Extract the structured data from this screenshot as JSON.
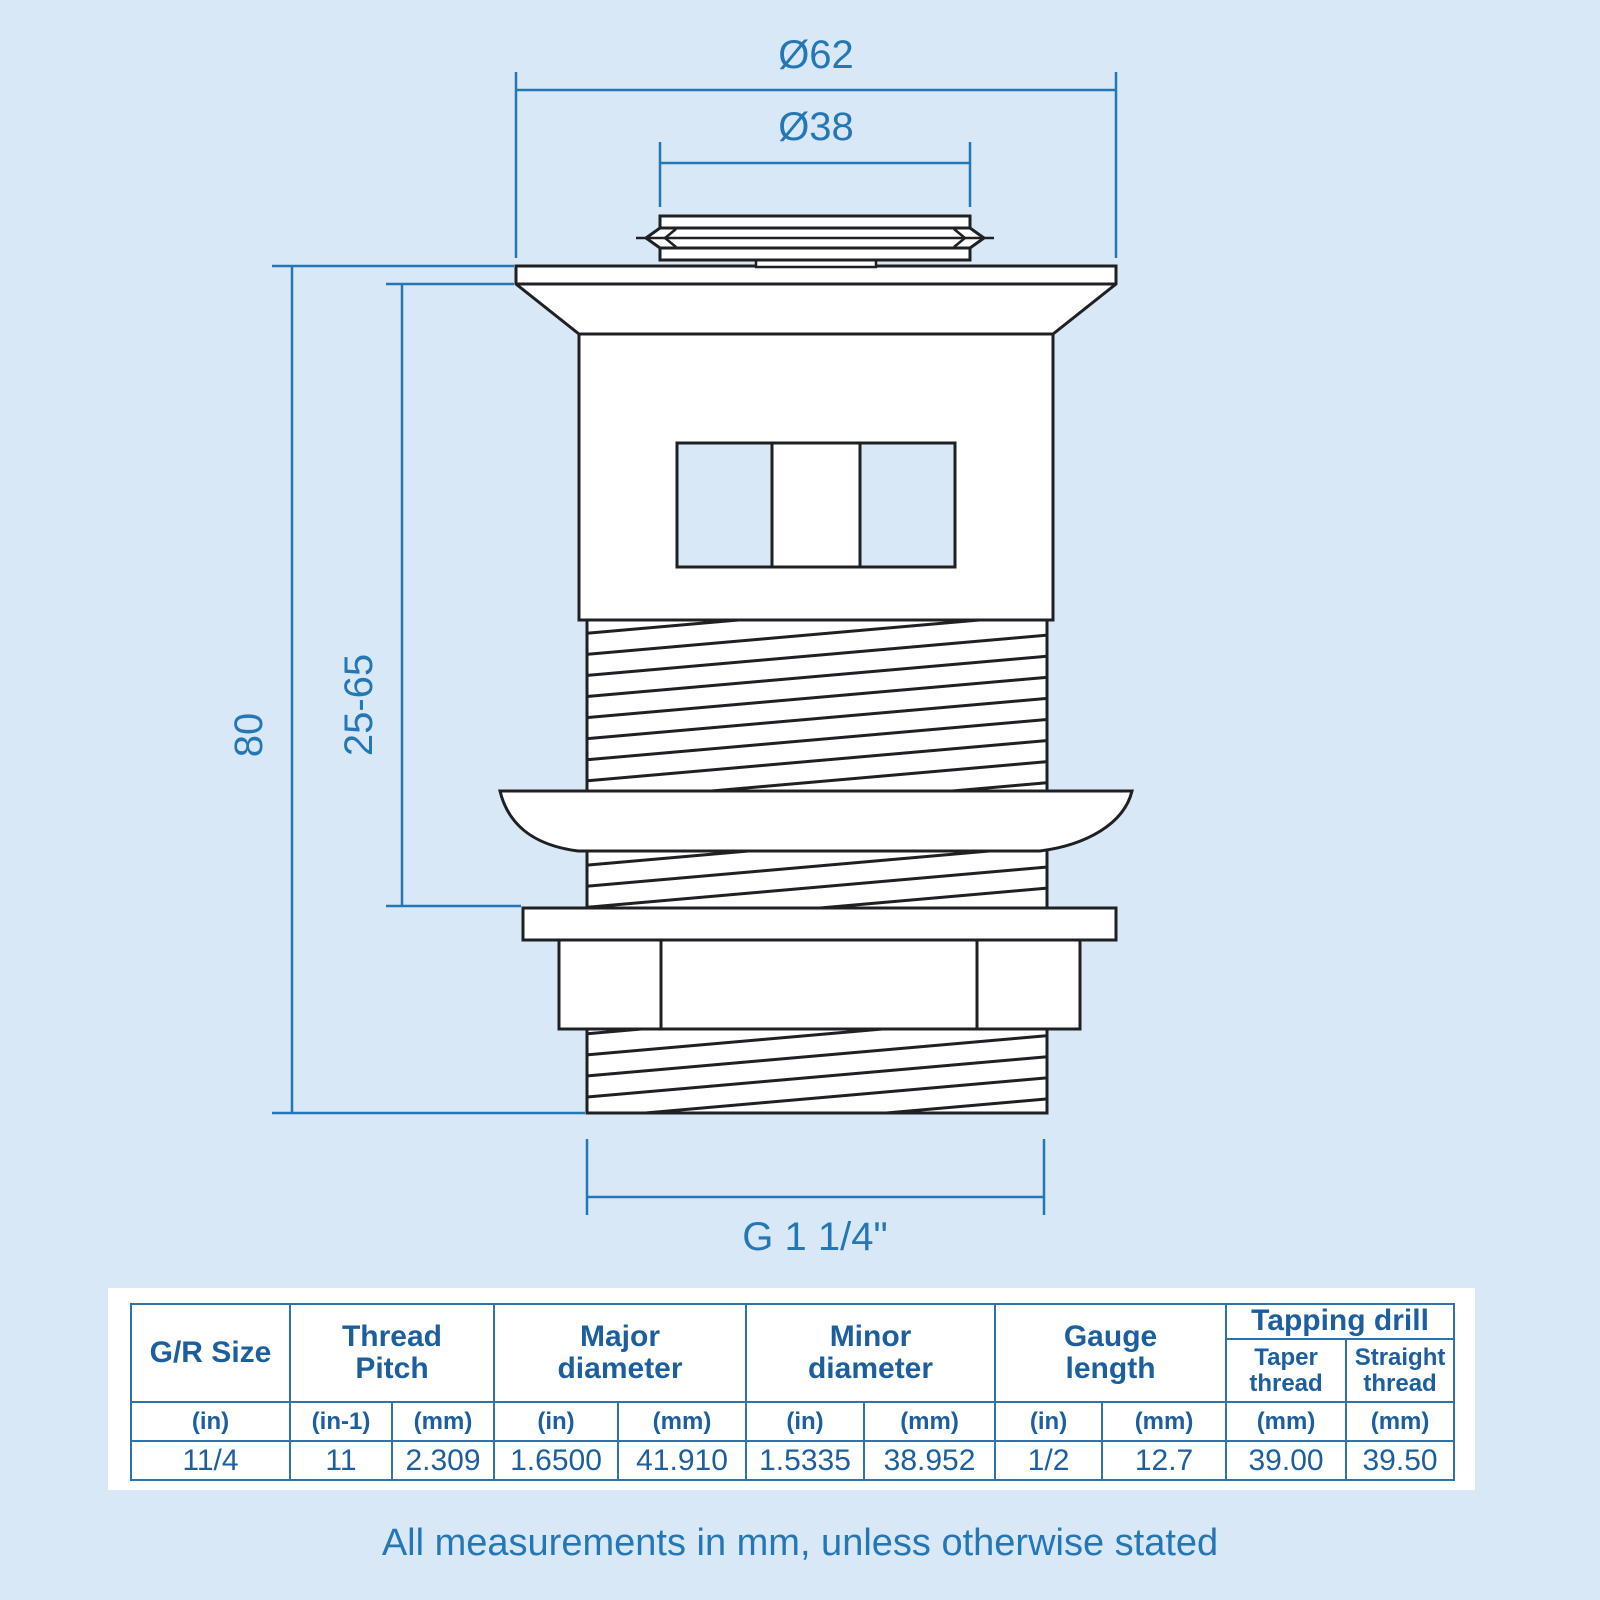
{
  "page": {
    "background": "#d8e8f6",
    "note": "All measurements in mm, unless otherwise stated"
  },
  "colors": {
    "drawing_line": "#1f2023",
    "dimension_blue": "#2576b4",
    "table_text": "#1d5e9e",
    "table_border": "#2e74ab"
  },
  "diagram": {
    "dim_outer_diameter": "Ø62",
    "dim_inner_diameter": "Ø38",
    "dim_total_height": "80",
    "dim_clamp_range": "25-65",
    "dim_thread_size": "G 1 1/4\""
  },
  "table": {
    "headers": {
      "gr_size": "G/R Size",
      "thread_pitch": "Thread Pitch",
      "major_diameter": "Major diameter",
      "minor_diameter": "Minor diameter",
      "gauge_length": "Gauge length",
      "tapping_drill": "Tapping drill",
      "taper_thread": "Taper thread",
      "straight_thread": "Straight thread"
    },
    "units": [
      "(in)",
      "(in-1)",
      "(mm)",
      "(in)",
      "(mm)",
      "(in)",
      "(mm)",
      "(in)",
      "(mm)",
      "(mm)",
      "(mm)"
    ],
    "values": [
      "11/4",
      "11",
      "2.309",
      "1.6500",
      "41.910",
      "1.5335",
      "38.952",
      "1/2",
      "12.7",
      "39.00",
      "39.50"
    ]
  }
}
